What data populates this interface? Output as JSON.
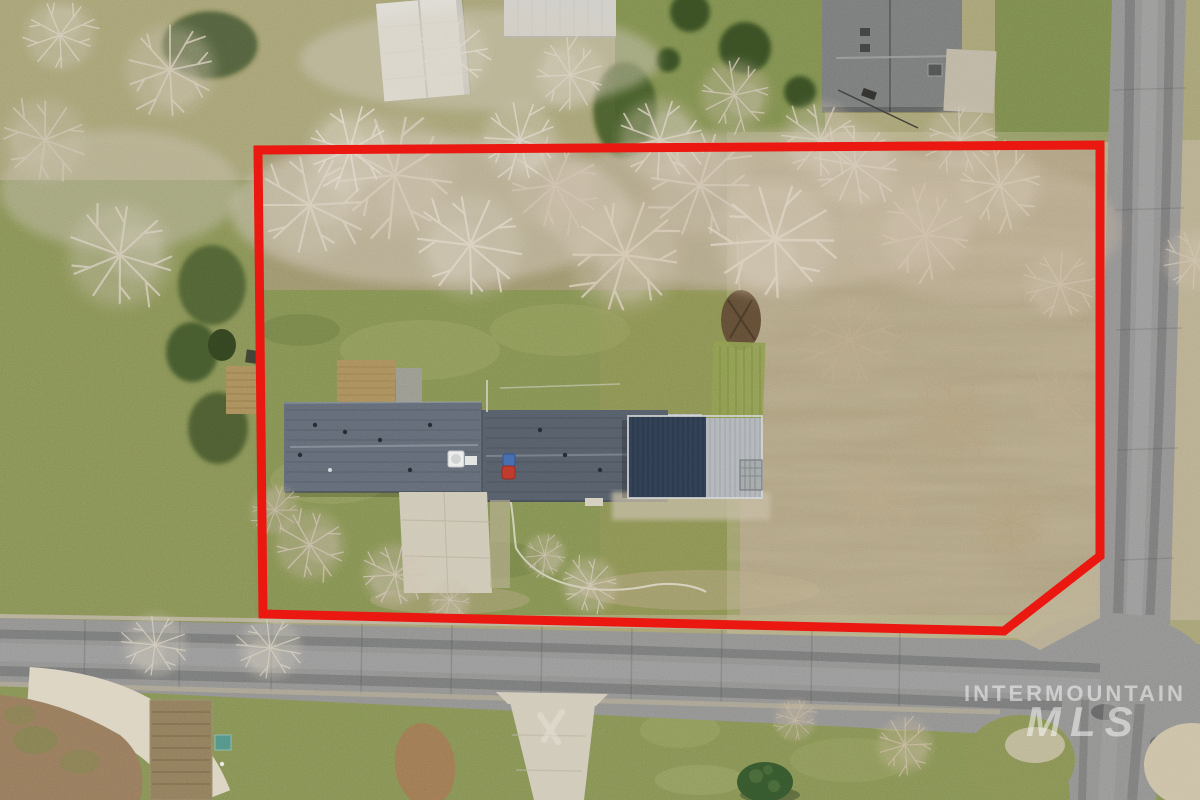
{
  "watermark": {
    "line1": "INTERMOUNTAIN",
    "line2": "MLS"
  },
  "boundary": {
    "points": "258,150 1100,145 1100,556 1004,631 263,614",
    "color": "#e8150f",
    "stroke_width": 9
  },
  "colors": {
    "boundary-red": "#e8150f",
    "asphalt": "#87888a",
    "asphalt-dark": "#5a5b5d",
    "asphalt-light": "#9a9b9d",
    "house-roof": "#5a6370",
    "house-roof-dark": "#4e5763",
    "shop-roof-dark": "#2c3a4e",
    "shop-roof-light": "#a9afb6",
    "neighbor-roof": "#707375",
    "shed-white": "#dad8d1",
    "lawn-green": "#79874e",
    "lawn-light": "#8d9a5e",
    "olive-grass": "#9e9a70",
    "scrub-tan": "#9c8e6f",
    "canopy-tan": "#cfc3b2",
    "concrete": "#cbc5b4",
    "gravel": "#d8d0be",
    "garden-dirt": "#857457",
    "evergreen": "#344a22",
    "deck-wood": "#a08457",
    "teal-shed": "#4d8a80",
    "barrel-red": "#b5352a",
    "barrel-blue": "#3f62a8"
  }
}
